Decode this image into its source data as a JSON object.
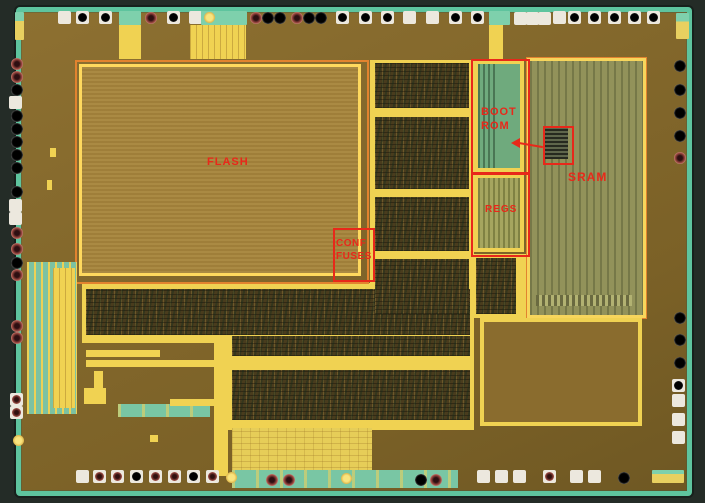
{
  "figure": {
    "title": "Annotated microcontroller die photograph"
  },
  "annotations": {
    "flash": {
      "label": "FLASH"
    },
    "boot_rom": {
      "line1": "BOOT",
      "line2": "ROM"
    },
    "sram": {
      "label": "SRAM"
    },
    "regs": {
      "label": "REGS"
    },
    "conf_fuses": {
      "line1": "CONF",
      "line2": "FUSES"
    }
  },
  "palette": {
    "red": "#e8281a",
    "teal": "#5ec49e",
    "outer": "#242c27",
    "die1": "#8d7031",
    "die2": "#7b6127",
    "tan": "#a5843c",
    "yellow": "#f0d252",
    "orange": "#e2832f",
    "dark": "#493c1d",
    "olive": "#92925a",
    "green": "#6faa7d",
    "regsol": "#a6a65f",
    "padwhite": "#ece8de"
  },
  "pads": {
    "items": [
      {
        "x": 58,
        "y": 11,
        "t": "sqw"
      },
      {
        "x": 76,
        "y": 11,
        "t": "sqb"
      },
      {
        "x": 99,
        "y": 11,
        "t": "sqb"
      },
      {
        "x": 119,
        "y": 11,
        "t": "teal",
        "w": 22,
        "h": 14
      },
      {
        "x": 145,
        "y": 12,
        "t": "red"
      },
      {
        "x": 167,
        "y": 11,
        "t": "sqb"
      },
      {
        "x": 189,
        "y": 11,
        "t": "sqw"
      },
      {
        "x": 201,
        "y": 11,
        "t": "teal",
        "w": 46,
        "h": 14
      },
      {
        "x": 204,
        "y": 12,
        "t": "yel"
      },
      {
        "x": 250,
        "y": 12,
        "t": "red"
      },
      {
        "x": 262,
        "y": 12,
        "t": "blk"
      },
      {
        "x": 274,
        "y": 12,
        "t": "blk"
      },
      {
        "x": 291,
        "y": 12,
        "t": "red"
      },
      {
        "x": 303,
        "y": 12,
        "t": "blk"
      },
      {
        "x": 315,
        "y": 12,
        "t": "blk"
      },
      {
        "x": 336,
        "y": 11,
        "t": "sqb"
      },
      {
        "x": 359,
        "y": 11,
        "t": "sqb"
      },
      {
        "x": 381,
        "y": 11,
        "t": "sqb"
      },
      {
        "x": 403,
        "y": 11,
        "t": "sqw"
      },
      {
        "x": 426,
        "y": 11,
        "t": "sqw"
      },
      {
        "x": 449,
        "y": 11,
        "t": "sqb"
      },
      {
        "x": 471,
        "y": 11,
        "t": "sqb"
      },
      {
        "x": 489,
        "y": 11,
        "t": "teal",
        "w": 21,
        "h": 14
      },
      {
        "x": 514,
        "y": 12,
        "t": "sqw"
      },
      {
        "x": 526,
        "y": 12,
        "t": "sqw"
      },
      {
        "x": 538,
        "y": 12,
        "t": "sqw"
      },
      {
        "x": 553,
        "y": 11,
        "t": "sqw"
      },
      {
        "x": 568,
        "y": 11,
        "t": "sqb"
      },
      {
        "x": 588,
        "y": 11,
        "t": "sqb"
      },
      {
        "x": 608,
        "y": 11,
        "t": "sqb"
      },
      {
        "x": 628,
        "y": 11,
        "t": "sqb"
      },
      {
        "x": 647,
        "y": 11,
        "t": "sqb"
      },
      {
        "x": 676,
        "y": 13,
        "t": "tealy",
        "w": 13,
        "h": 26
      },
      {
        "x": 11,
        "y": 58,
        "t": "red"
      },
      {
        "x": 11,
        "y": 71,
        "t": "red"
      },
      {
        "x": 11,
        "y": 84,
        "t": "blk"
      },
      {
        "x": 9,
        "y": 96,
        "t": "sqw"
      },
      {
        "x": 11,
        "y": 110,
        "t": "blk"
      },
      {
        "x": 11,
        "y": 123,
        "t": "blk"
      },
      {
        "x": 11,
        "y": 136,
        "t": "blk"
      },
      {
        "x": 11,
        "y": 149,
        "t": "blk"
      },
      {
        "x": 11,
        "y": 162,
        "t": "blk"
      },
      {
        "x": 11,
        "y": 186,
        "t": "blk"
      },
      {
        "x": 9,
        "y": 199,
        "t": "sqw"
      },
      {
        "x": 9,
        "y": 212,
        "t": "sqw"
      },
      {
        "x": 11,
        "y": 227,
        "t": "red"
      },
      {
        "x": 11,
        "y": 243,
        "t": "red"
      },
      {
        "x": 11,
        "y": 257,
        "t": "blk"
      },
      {
        "x": 11,
        "y": 269,
        "t": "red"
      },
      {
        "x": 11,
        "y": 320,
        "t": "red"
      },
      {
        "x": 11,
        "y": 332,
        "t": "red"
      },
      {
        "x": 10,
        "y": 393,
        "t": "sqr"
      },
      {
        "x": 10,
        "y": 406,
        "t": "sqr"
      },
      {
        "x": 13,
        "y": 435,
        "t": "yel"
      },
      {
        "x": 674,
        "y": 60,
        "t": "blk"
      },
      {
        "x": 674,
        "y": 84,
        "t": "blk"
      },
      {
        "x": 674,
        "y": 107,
        "t": "blk"
      },
      {
        "x": 674,
        "y": 130,
        "t": "blk"
      },
      {
        "x": 674,
        "y": 152,
        "t": "red"
      },
      {
        "x": 674,
        "y": 312,
        "t": "blk"
      },
      {
        "x": 674,
        "y": 334,
        "t": "blk"
      },
      {
        "x": 674,
        "y": 357,
        "t": "blk"
      },
      {
        "x": 672,
        "y": 379,
        "t": "sqb"
      },
      {
        "x": 672,
        "y": 394,
        "t": "sqw"
      },
      {
        "x": 672,
        "y": 413,
        "t": "sqw"
      },
      {
        "x": 672,
        "y": 431,
        "t": "sqw"
      },
      {
        "x": 76,
        "y": 470,
        "t": "sqw"
      },
      {
        "x": 93,
        "y": 470,
        "t": "sqr"
      },
      {
        "x": 111,
        "y": 470,
        "t": "sqr"
      },
      {
        "x": 130,
        "y": 470,
        "t": "sqb"
      },
      {
        "x": 149,
        "y": 470,
        "t": "sqr"
      },
      {
        "x": 168,
        "y": 470,
        "t": "sqr"
      },
      {
        "x": 187,
        "y": 470,
        "t": "sqb"
      },
      {
        "x": 206,
        "y": 470,
        "t": "sqr"
      },
      {
        "x": 226,
        "y": 472,
        "t": "yel"
      },
      {
        "x": 266,
        "y": 474,
        "t": "red"
      },
      {
        "x": 283,
        "y": 474,
        "t": "red"
      },
      {
        "x": 341,
        "y": 473,
        "t": "yel"
      },
      {
        "x": 415,
        "y": 474,
        "t": "blk"
      },
      {
        "x": 430,
        "y": 474,
        "t": "red"
      },
      {
        "x": 477,
        "y": 470,
        "t": "sqw"
      },
      {
        "x": 495,
        "y": 470,
        "t": "sqw"
      },
      {
        "x": 513,
        "y": 470,
        "t": "sqw"
      },
      {
        "x": 543,
        "y": 470,
        "t": "sqr"
      },
      {
        "x": 570,
        "y": 470,
        "t": "sqw"
      },
      {
        "x": 588,
        "y": 470,
        "t": "sqw"
      },
      {
        "x": 618,
        "y": 472,
        "t": "blk"
      },
      {
        "x": 652,
        "y": 470,
        "t": "tealy",
        "w": 32,
        "h": 13
      }
    ]
  }
}
